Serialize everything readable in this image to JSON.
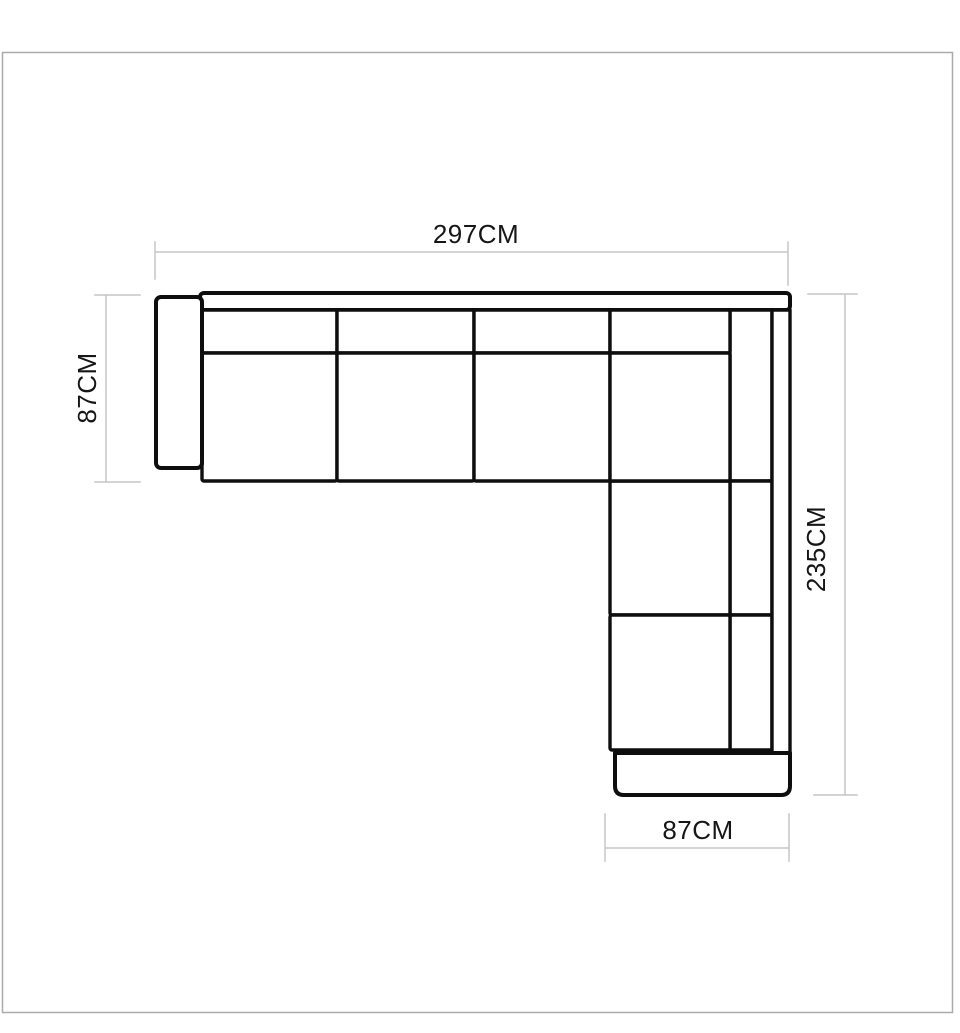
{
  "diagram": {
    "labels": {
      "top": "297CM",
      "left": "87CM",
      "right": "235CM",
      "bottom": "87CM"
    },
    "colors": {
      "outline": "#0e0e0e",
      "dimension_line": "#c5c5c5",
      "label_text": "#161616",
      "frame_border": "#ababab",
      "background": "#ffffff"
    }
  }
}
